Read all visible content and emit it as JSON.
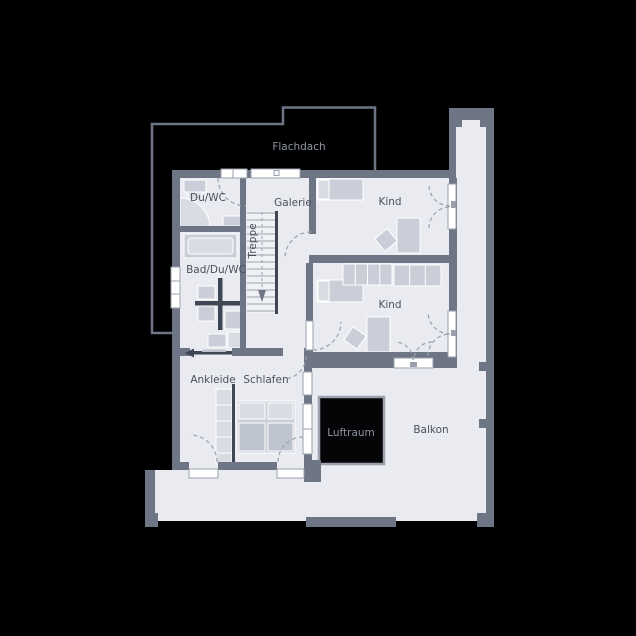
{
  "labels": {
    "flachdach": "Flachdach",
    "du_wc": "Du/WC",
    "galerie": "Galerie",
    "kind_upper": "Kind",
    "bad_du_wc": "Bad/Du/WC",
    "treppe": "Treppe",
    "kind_lower": "Kind",
    "ankleide": "Ankleide",
    "schlafen": "Schlafen",
    "luftraum": "Luftraum",
    "balkon": "Balkon"
  },
  "colors": {
    "bg": "#000000",
    "wall": "#6e7585",
    "floor": "#e9ebf0",
    "furniture": "#c9ced8",
    "furniture-light": "#d9dce3",
    "furniture-dark": "#bec4cf",
    "accent-dark": "#3f4654",
    "line": "#9aa1ad",
    "label-dark": "#4a5160",
    "label-light": "#8d94a1",
    "void": "#050507",
    "window": "#ffffff"
  }
}
